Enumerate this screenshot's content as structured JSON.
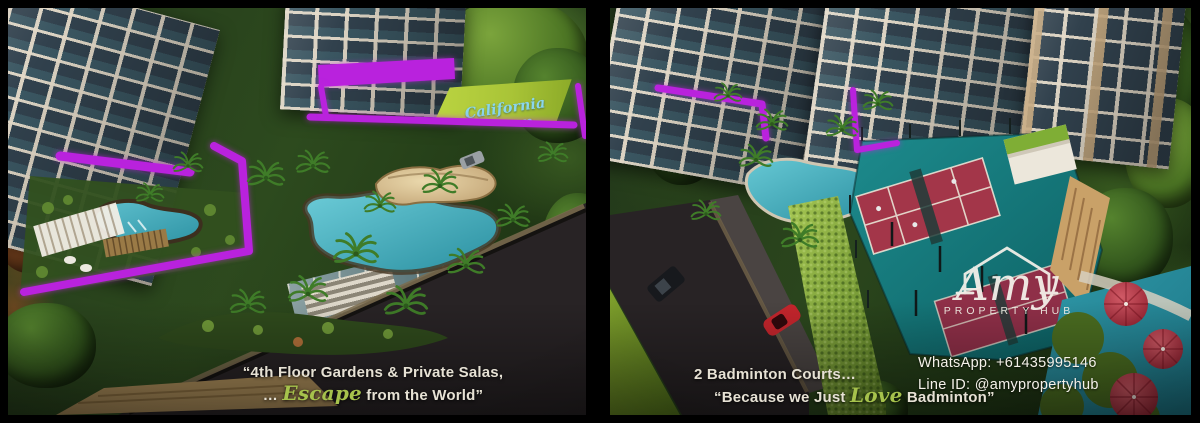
{
  "brand": {
    "logo_name": "Amy",
    "logo_tagline": "PROPERTY HUB"
  },
  "contact": {
    "whatsapp": "WhatsApp: +61435995146",
    "line_id": "Line ID: @amypropertyhub"
  },
  "left_panel": {
    "banner_text": "California dream",
    "caption_line1": "“4th Floor Gardens & Private Salas,",
    "caption_line2_prefix": "… ",
    "caption_line2_script": "Escape",
    "caption_line2_suffix": " from the World”"
  },
  "right_panel": {
    "caption_line1": "2 Badminton Courts…",
    "caption_line2_prefix": "“Because we Just ",
    "caption_line2_script": "Love",
    "caption_line2_suffix": " Badminton”"
  },
  "colors": {
    "accent_magenta": "#b922dd",
    "script_green": "#a6c24c",
    "banner_green": "#a9c437",
    "banner_text_cyan": "#8ad6ec",
    "court_teal": "#15797c",
    "court_red": "#a33649",
    "pool_teal": "#3fa8b8",
    "green_wall": "#8fb43e",
    "text_light": "#e6e1d4"
  }
}
